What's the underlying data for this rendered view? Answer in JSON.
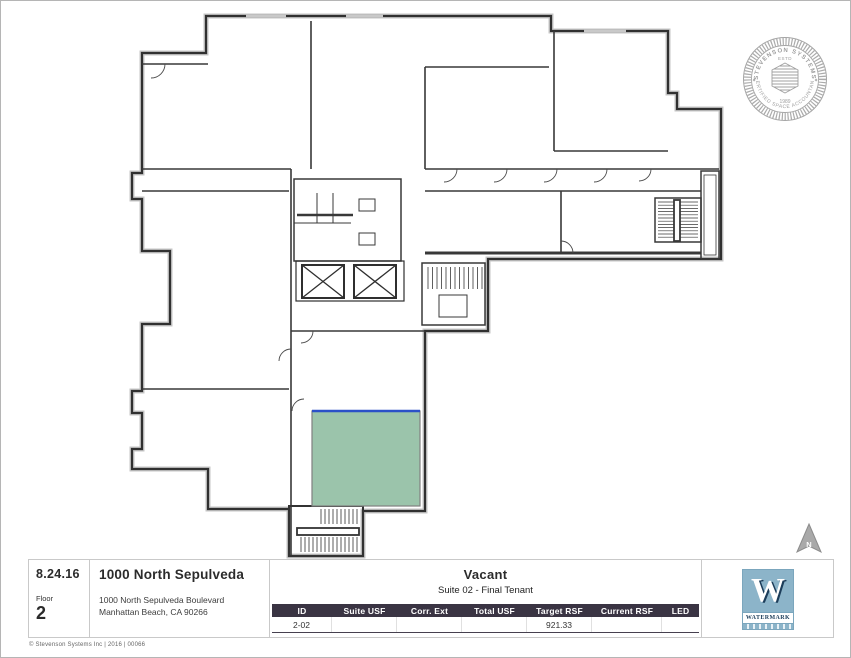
{
  "plan": {
    "suite_fill_color": "#9bc4ab",
    "demising_line_color": "#2b50c8",
    "wall_color": "#333333",
    "suite_name": "suite-2-02"
  },
  "seal": {
    "arc_top": "STEVENSON SYSTEMS",
    "arc_bottom": "CERTIFIED SPACE ACCOUNTANT",
    "estd": "ESTD",
    "year": "1989",
    "star_left": "✦",
    "star_right": "✦"
  },
  "north_arrow": {
    "label": "N"
  },
  "footer": {
    "date": "8.24.16",
    "floor_label": "Floor",
    "floor_number": "2",
    "building_name": "1000 North Sepulveda",
    "address_line1": "1000 North Sepulveda Boulevard",
    "address_line2": "Manhattan Beach, CA 90266",
    "tenant_status": "Vacant",
    "tenant_subtitle": "Suite 02 - Final Tenant",
    "table": {
      "columns": [
        "ID",
        "Suite USF",
        "Corr. Ext",
        "Total USF",
        "Target RSF",
        "Current RSF",
        "LED"
      ],
      "row": {
        "id": "2-02",
        "suite_usf": "",
        "corr_ext": "",
        "total_usf": "",
        "target_rsf": "921.33",
        "current_rsf": "",
        "led": ""
      },
      "header_bg": "#3a3443"
    },
    "copyright": "© Stevenson Systems Inc | 2016 | 00066"
  },
  "logos": {
    "watermark": {
      "letter": "W",
      "name": "WATERMARK"
    }
  }
}
